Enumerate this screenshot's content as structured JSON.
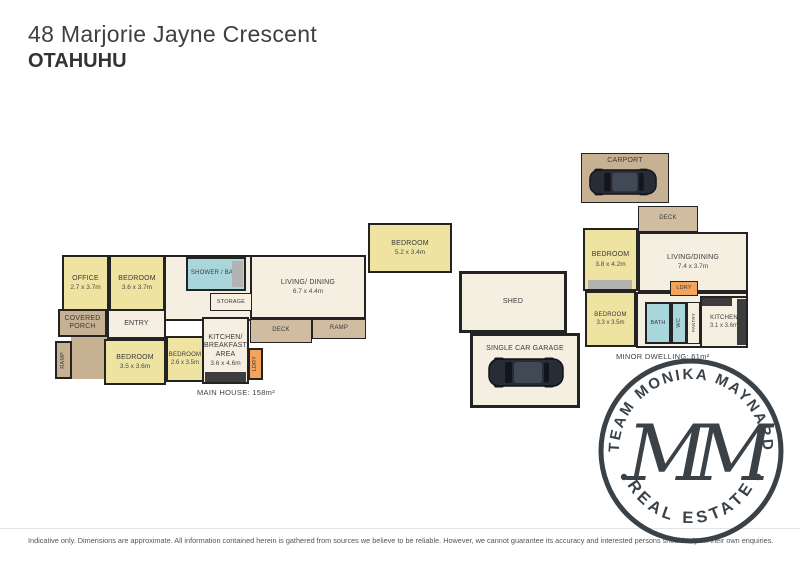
{
  "header": {
    "address": "48 Marjorie Jayne Crescent",
    "suburb": "OTAHUHU"
  },
  "colors": {
    "room_yellow": "#eee3a1",
    "room_cream": "#f4efe1",
    "outdoor_tan": "#c7b193",
    "wet_area_blue": "#a9d6da",
    "laundry_orange": "#f2a35c",
    "wall": "#232323",
    "stamp": "#3b4247"
  },
  "main_house": {
    "caption": "MAIN HOUSE: 158m²",
    "rooms": {
      "office": {
        "name": "OFFICE",
        "dims": "2.7 x 3.7m"
      },
      "bedroom1": {
        "name": "BEDROOM",
        "dims": "3.6 x 3.7m"
      },
      "shower_bath": {
        "name": "SHOWER / BATH"
      },
      "storage": {
        "name": "STORAGE"
      },
      "entry": {
        "name": "ENTRY"
      },
      "covered_porch": {
        "name": "COVERED PORCH"
      },
      "ramp_left": {
        "name": "RAMP"
      },
      "bedroom2": {
        "name": "BEDROOM",
        "dims": "3.5 x 3.6m"
      },
      "bedroom3": {
        "name": "BEDROOM",
        "dims": "2.6 x 3.5m"
      },
      "kitchen": {
        "name": "KITCHEN/ BREAKFAST AREA",
        "dims": "3.6 x 4.6m"
      },
      "laundry": {
        "name": "LDRY"
      },
      "deck": {
        "name": "DECK"
      },
      "ramp_rear": {
        "name": "RAMP"
      },
      "living": {
        "name": "LIVING/ DINING",
        "dims": "6.7 x 4.4m"
      },
      "bedroom4": {
        "name": "BEDROOM",
        "dims": "5.2 x 3.4m"
      }
    }
  },
  "outbuildings": {
    "shed": {
      "name": "SHED"
    },
    "garage": {
      "name": "SINGLE CAR GARAGE"
    }
  },
  "minor_dwelling": {
    "caption": "MINOR DWELLING: 61m²",
    "rooms": {
      "carport": {
        "name": "CARPORT"
      },
      "deck": {
        "name": "DECK"
      },
      "bedroom1": {
        "name": "BEDROOM",
        "dims": "3.8 x 4.2m"
      },
      "living": {
        "name": "LIVING/DINING",
        "dims": "7.4 x 3.7m"
      },
      "laundry": {
        "name": "LDRY"
      },
      "bedroom2": {
        "name": "BEDROOM",
        "dims": "3.3 x 3.5m"
      },
      "bath": {
        "name": "BATH"
      },
      "wc": {
        "name": "WC"
      },
      "pantry": {
        "name": "PANTRY"
      },
      "kitchen": {
        "name": "KITCHEN",
        "dims": "3.1 x 3.6m"
      }
    }
  },
  "stamp": {
    "top_text": "TEAM MONIKA MAYNARD",
    "bottom_text": "REAL ESTATE",
    "monogram": "MM"
  },
  "footer": {
    "disclaimer": "Indicative only. Dimensions are approximate. All information contained herein is gathered from sources we believe to be reliable. However, we cannot guarantee its accuracy and interested persons should rely on their own enquiries."
  }
}
